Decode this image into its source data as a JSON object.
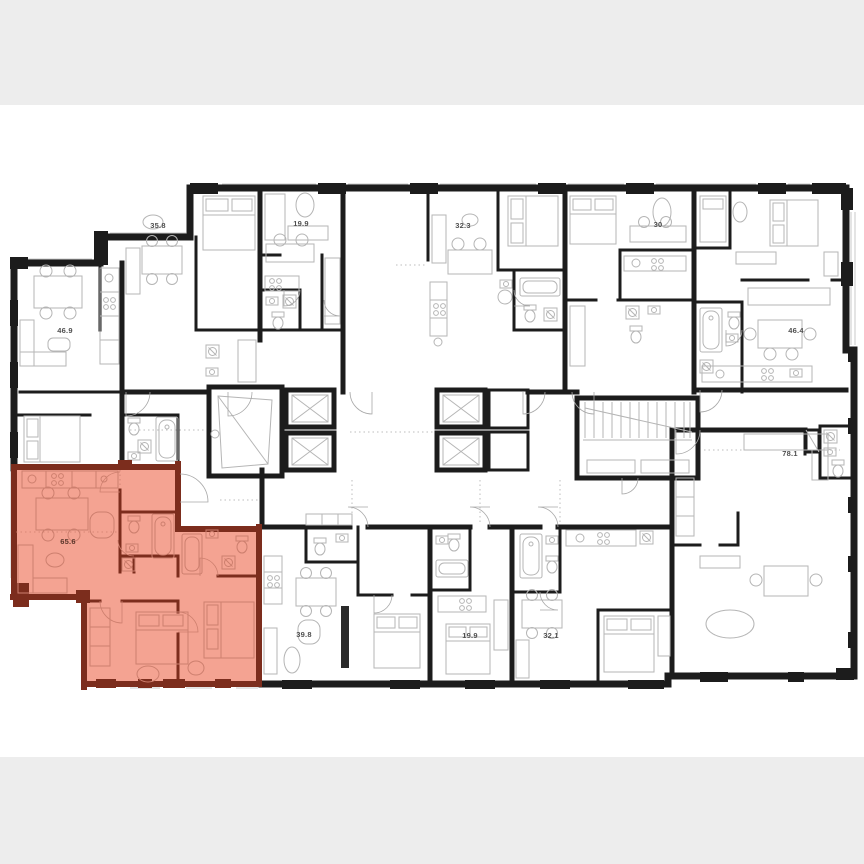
{
  "page": {
    "canvas_color": "#ffffff",
    "top_bar_color": "#ededed",
    "bottom_bar_color": "#ededed"
  },
  "floorplan": {
    "kind": "residential-building-floor-plan",
    "wall_color": "#1c1c1c",
    "furniture_color": "#b5b5b5",
    "label_color": "#4f4f4f",
    "highlight": {
      "fill": "#f4a392",
      "wall_color": "#7c2d1d",
      "furniture_color": "#cd7f6e",
      "label_color": "#5a352a"
    },
    "units": [
      {
        "id": "unit-top-corner-left",
        "area": "46.9",
        "highlighted": false
      },
      {
        "id": "unit-top-1",
        "area": "35.8",
        "highlighted": false
      },
      {
        "id": "unit-top-2",
        "area": "19.9",
        "highlighted": false
      },
      {
        "id": "unit-top-3",
        "area": "32.3",
        "highlighted": false
      },
      {
        "id": "unit-top-4",
        "area": "30",
        "highlighted": false
      },
      {
        "id": "unit-top-corner-right",
        "area": "46.4",
        "highlighted": false
      },
      {
        "id": "unit-bottom-corner-left",
        "area": "65.6",
        "highlighted": true
      },
      {
        "id": "unit-bottom-1",
        "area": "39.8",
        "highlighted": false
      },
      {
        "id": "unit-bottom-2",
        "area": "19.9",
        "highlighted": false
      },
      {
        "id": "unit-bottom-3",
        "area": "32.1",
        "highlighted": false
      },
      {
        "id": "unit-bottom-corner-right",
        "area": "78.1",
        "highlighted": false
      }
    ],
    "core": {
      "elevator_shafts": 4,
      "stairwells": 2
    }
  }
}
